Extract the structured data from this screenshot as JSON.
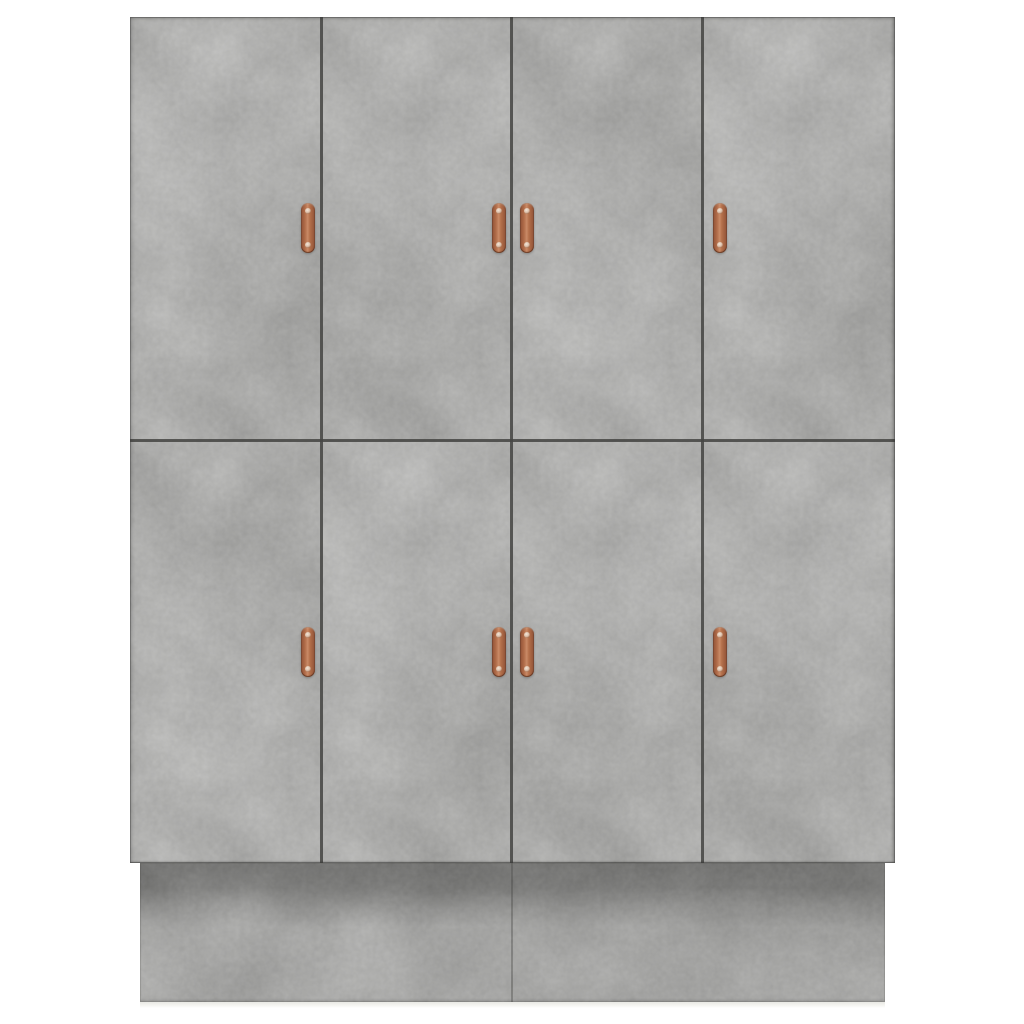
{
  "scene": {
    "description": "Product photo of a tall concrete-gray wardrobe with eight flat doors and vertical copper strap handles, standing on a recessed plinth base against a plain white background",
    "object": "8-door wardrobe cabinet",
    "finish": "concrete gray",
    "background_color": "#ffffff",
    "door_grid": {
      "columns": 4,
      "rows": 2
    },
    "handle_count": 8,
    "handle_style": "vertical copper strap pull with two screws, rounded ends",
    "handle_layout": "doors 1-2 carry handles near their right edge, doors 3-4 near their left edge; the two center handles meet as a pair at the middle seam; handles vertically centered in each door row",
    "base": "recessed plinth slightly inset from the door faces with a dark shadow band beneath the door overhang and a center seam",
    "colors": {
      "background": "#ffffff",
      "door_base": "#bcbcba",
      "plinth_base": "#b0b0ae",
      "seam": "#454543",
      "copper_light": "#c98a67",
      "copper_mid": "#b06c49",
      "copper_mid2": "#b5714c",
      "copper_dark": "#8f5136",
      "screw_face": "#f3e6d8"
    }
  }
}
